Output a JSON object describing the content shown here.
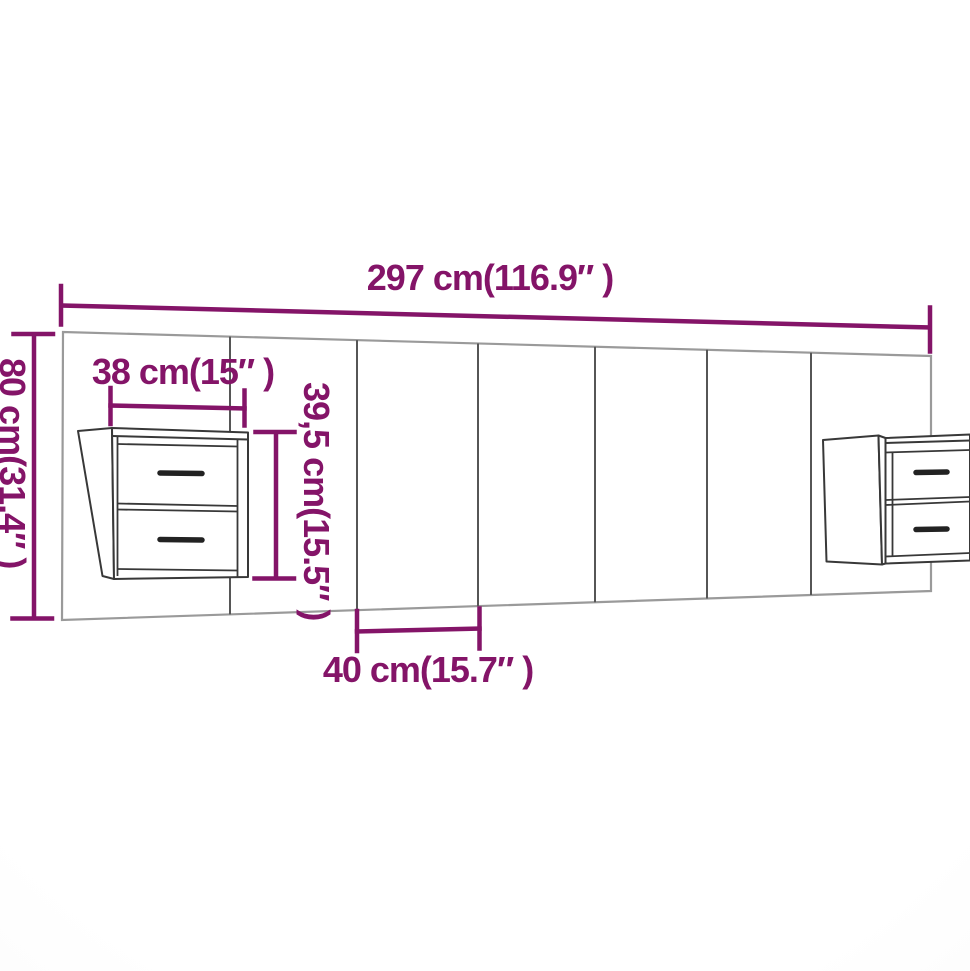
{
  "diagram": {
    "kind": "furniture-dimension-diagram",
    "labels": {
      "total_width": "297 cm(116.9″ )",
      "height": "80 cm(31.4″ )",
      "cabinet_width": "38 cm(15″ )",
      "cabinet_height": "39,5 cm(15.5″ )",
      "panel_width": "40 cm(15.7″ )"
    },
    "colors": {
      "dimension_accent": "#841468",
      "furniture_line": "#383838",
      "panel_line": "#565656",
      "headboard_outline": "#9a9a9a",
      "background": "#ffffff"
    }
  }
}
